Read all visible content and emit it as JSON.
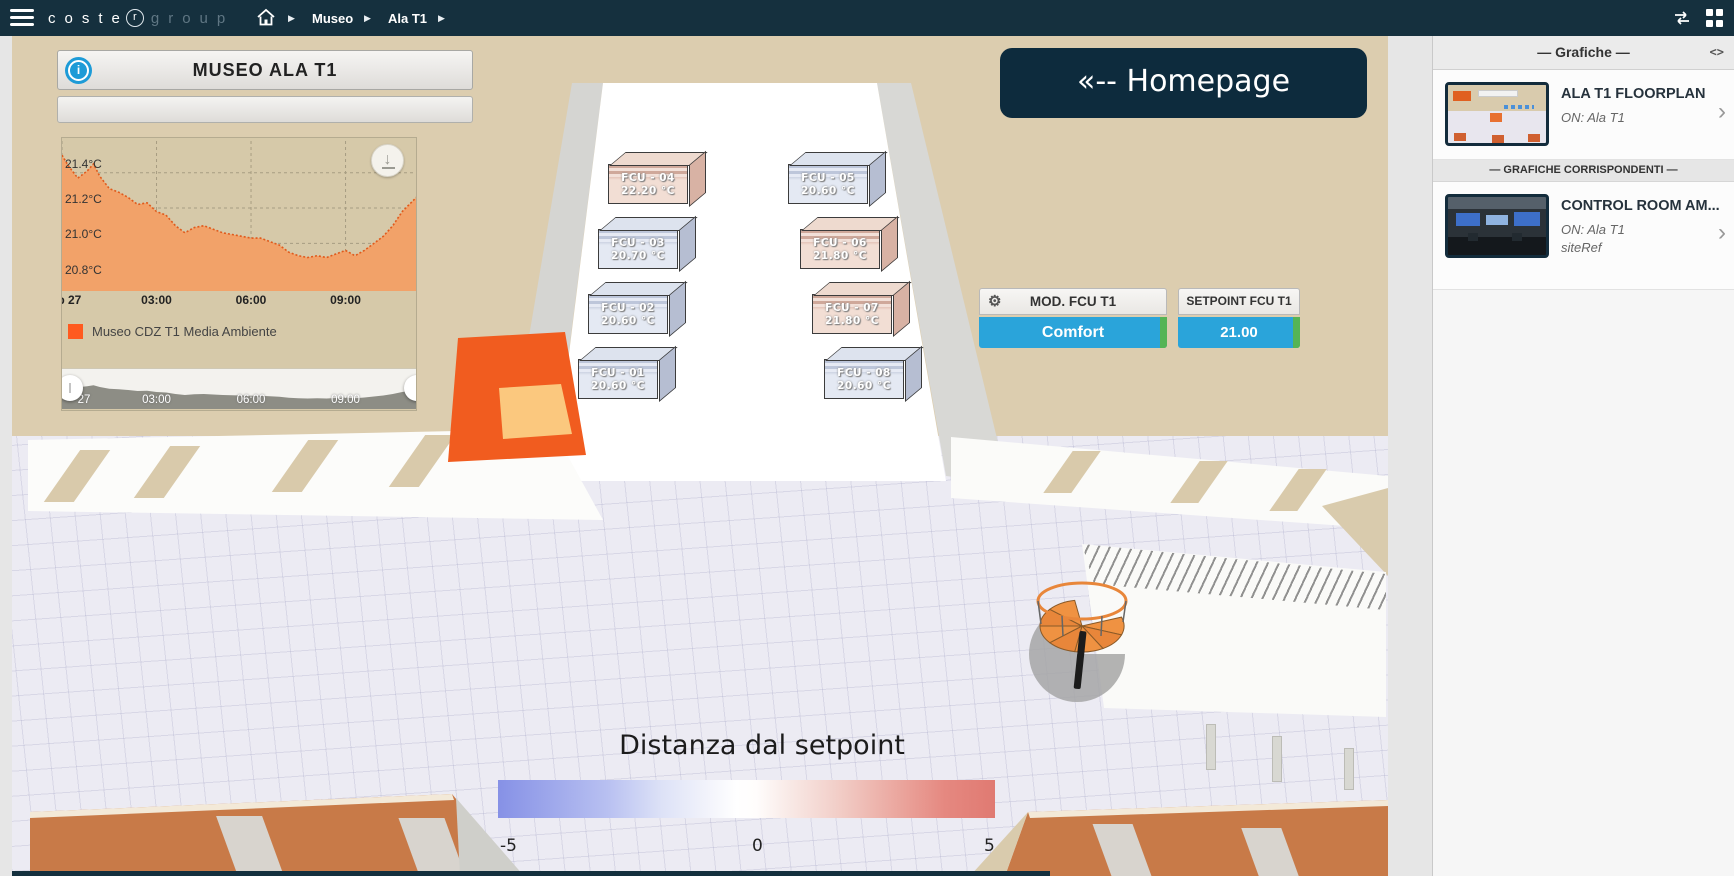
{
  "topbar": {
    "logo_main": "coste",
    "logo_r": "r",
    "logo_sub": "group",
    "breadcrumb": [
      "Museo",
      "Ala T1"
    ]
  },
  "icons": {
    "gear_glyph": "⚙",
    "info_glyph": "i",
    "download_glyph": "↓",
    "chevron_glyph": "›",
    "code_glyph": "<>",
    "separator_glyph": "▶"
  },
  "widgets": {
    "title": "MUSEO ALA T1",
    "homepage_label": "«-- Homepage",
    "mod": {
      "label": "MOD. FCU T1",
      "value": "Comfort"
    },
    "setpoint": {
      "label": "SETPOINT FCU T1",
      "value": "21.00"
    },
    "distance_legend": {
      "title": "Distanza dal setpoint",
      "min": "-5",
      "mid": "0",
      "max": "5"
    }
  },
  "scene": {
    "fcu_units": [
      {
        "name": "FCU - 04",
        "temp": "22.20 °C",
        "state": "warm"
      },
      {
        "name": "FCU - 03",
        "temp": "20.70 °C",
        "state": "cool"
      },
      {
        "name": "FCU - 02",
        "temp": "20.60 °C",
        "state": "cool"
      },
      {
        "name": "FCU - 01",
        "temp": "20.60 °C",
        "state": "cool"
      },
      {
        "name": "FCU - 05",
        "temp": "20.60 °C",
        "state": "cool"
      },
      {
        "name": "FCU - 06",
        "temp": "21.80 °C",
        "state": "warm"
      },
      {
        "name": "FCU - 07",
        "temp": "21.80 °C",
        "state": "warm"
      },
      {
        "name": "FCU - 08",
        "temp": "20.60 °C",
        "state": "cool"
      }
    ]
  },
  "chart_data": {
    "type": "area",
    "title": "",
    "xlabel": "",
    "ylabel": "",
    "series": [
      {
        "name": "Museo CDZ T1 Media Ambiente",
        "color": "#ff5a1f",
        "values": [
          21.5,
          21.44,
          21.37,
          21.41,
          21.45,
          21.38,
          21.31,
          21.29,
          21.26,
          21.22,
          21.23,
          21.18,
          21.16,
          21.1,
          21.06,
          21.09,
          21.1,
          21.08,
          21.06,
          21.05,
          21.04,
          21.03,
          21.03,
          21.01,
          20.99,
          20.95,
          20.93,
          20.92,
          20.93,
          20.92,
          20.94,
          20.96,
          20.93,
          20.96,
          21.0,
          21.04,
          21.1,
          21.18,
          21.27
        ]
      }
    ],
    "x_hours": [
      0,
      0.2,
      0.5,
      0.8,
      1.0,
      1.2,
      1.5,
      1.8,
      2.1,
      2.4,
      2.7,
      3.0,
      3.3,
      3.6,
      3.9,
      4.2,
      4.5,
      4.8,
      5.1,
      5.4,
      5.7,
      6.0,
      6.3,
      6.6,
      6.9,
      7.2,
      7.5,
      7.8,
      8.1,
      8.4,
      8.7,
      9.0,
      9.3,
      9.6,
      9.9,
      10.2,
      10.5,
      10.8,
      11.3
    ],
    "x_ticks": [
      "Sep 27",
      "03:00",
      "06:00",
      "09:00"
    ],
    "x_tick_hours": [
      0,
      3,
      6,
      9
    ],
    "y_ticks": [
      "21.4°C",
      "21.2°C",
      "21.0°C",
      "20.8°C"
    ],
    "y_tick_values": [
      21.4,
      21.2,
      21.0,
      20.8
    ],
    "ylim": [
      20.73,
      21.58
    ],
    "xlim_hours": [
      0,
      11.3
    ],
    "mini_ticks": [
      "27",
      "03:00",
      "06:00",
      "09:00"
    ],
    "mini_tick_hours": [
      0.7,
      3,
      6,
      9
    ],
    "mini_ylim": [
      20.5,
      22.1
    ],
    "grid": true,
    "legend_position": "bottom-left"
  },
  "sidebar": {
    "header": "— Grafiche —",
    "items": [
      {
        "title": "ALA T1 FLOORPLAN",
        "subtitle": "ON: Ala T1"
      }
    ],
    "divider": "— GRAFICHE CORRISPONDENTI —",
    "corresponding": [
      {
        "title": "CONTROL ROOM AM...",
        "subtitle": "ON: Ala T1",
        "ref": "siteRef"
      }
    ]
  },
  "colors": {
    "accent_blue": "#2aa4da",
    "ok_green": "#55b455",
    "series_orange": "#ff5a1f",
    "navy": "#15303e",
    "beige": "#dccdaf"
  }
}
